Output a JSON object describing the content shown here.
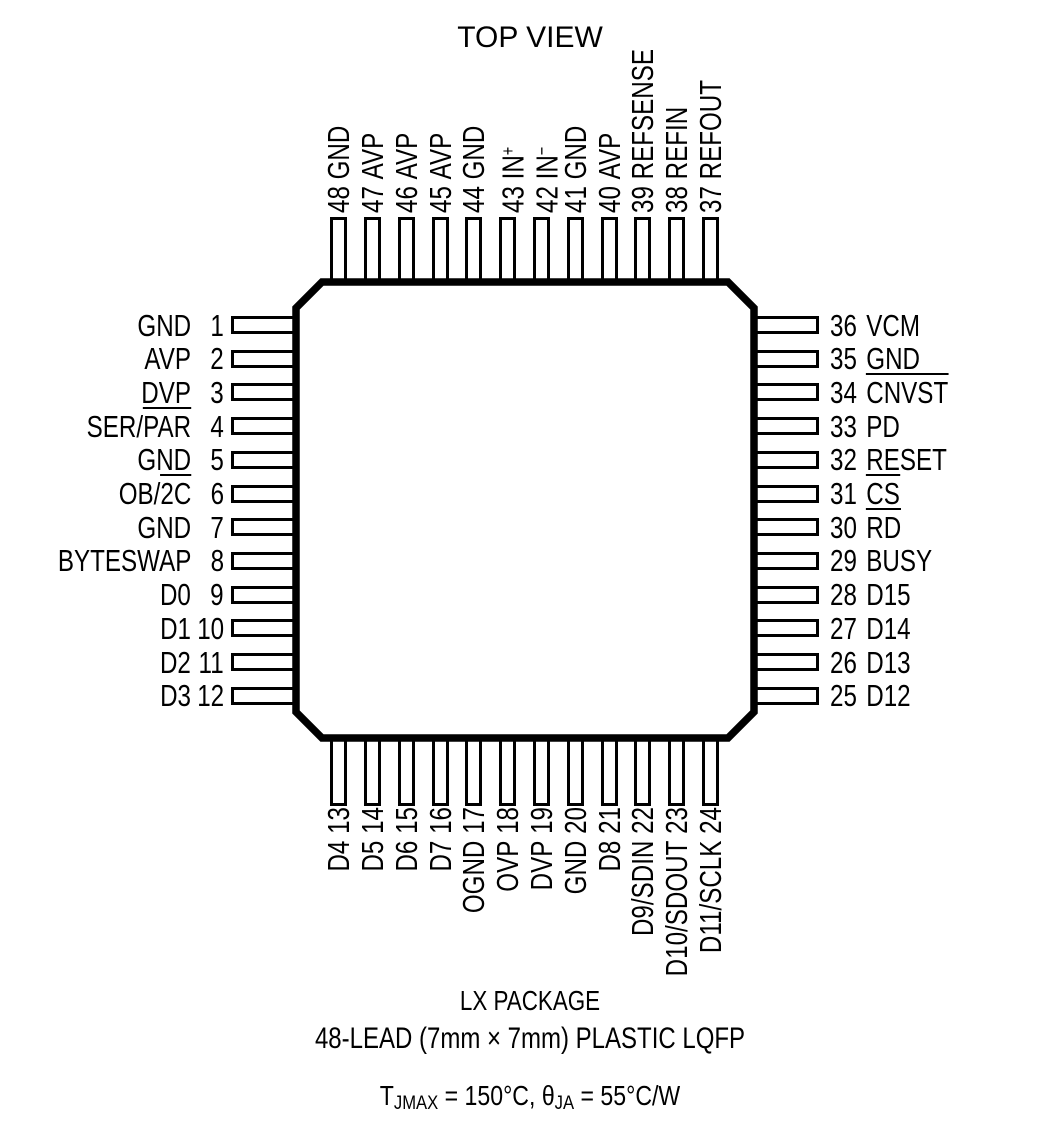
{
  "title": "TOP VIEW",
  "package": {
    "line1": "LX PACKAGE",
    "line2": "48-LEAD (7mm × 7mm) PLASTIC LQFP"
  },
  "thermal": {
    "t_prefix": "T",
    "t_sub": "JMAX",
    "mid": " = 150°C, θ",
    "ja_sub": "JA",
    "suffix": " = 55°C/W"
  },
  "colors": {
    "ink": "#000000",
    "background": "#ffffff"
  },
  "pins": {
    "top": [
      {
        "n": "48",
        "segs": [
          {
            "t": "GND"
          }
        ]
      },
      {
        "n": "47",
        "segs": [
          {
            "t": "AVP"
          }
        ]
      },
      {
        "n": "46",
        "segs": [
          {
            "t": "AVP"
          }
        ]
      },
      {
        "n": "45",
        "segs": [
          {
            "t": "AVP"
          }
        ]
      },
      {
        "n": "44",
        "segs": [
          {
            "t": "GND"
          }
        ]
      },
      {
        "n": "43",
        "segs": [
          {
            "t": "IN"
          },
          {
            "t": "+",
            "s": "sup"
          }
        ]
      },
      {
        "n": "42",
        "segs": [
          {
            "t": "IN"
          },
          {
            "t": "−",
            "s": "sup"
          }
        ]
      },
      {
        "n": "41",
        "segs": [
          {
            "t": "GND"
          }
        ]
      },
      {
        "n": "40",
        "segs": [
          {
            "t": "AVP"
          }
        ]
      },
      {
        "n": "39",
        "segs": [
          {
            "t": "REFSENSE"
          }
        ]
      },
      {
        "n": "38",
        "segs": [
          {
            "t": "REFIN"
          }
        ]
      },
      {
        "n": "37",
        "segs": [
          {
            "t": "REFOUT"
          }
        ]
      }
    ],
    "left": [
      {
        "n": "1",
        "segs": [
          {
            "t": "GND"
          }
        ]
      },
      {
        "n": "2",
        "segs": [
          {
            "t": "AVP"
          }
        ]
      },
      {
        "n": "3",
        "segs": [
          {
            "t": "DVP"
          }
        ]
      },
      {
        "n": "4",
        "segs": [
          {
            "t": "SER/"
          },
          {
            "t": "PAR",
            "s": "ov"
          }
        ]
      },
      {
        "n": "5",
        "segs": [
          {
            "t": "GND"
          }
        ]
      },
      {
        "n": "6",
        "segs": [
          {
            "t": "OB/"
          },
          {
            "t": "2C",
            "s": "ov"
          }
        ]
      },
      {
        "n": "7",
        "segs": [
          {
            "t": "GND"
          }
        ]
      },
      {
        "n": "8",
        "segs": [
          {
            "t": "BYTESWAP"
          }
        ]
      },
      {
        "n": "9",
        "segs": [
          {
            "t": "D0"
          }
        ]
      },
      {
        "n": "10",
        "segs": [
          {
            "t": "D1"
          }
        ]
      },
      {
        "n": "11",
        "segs": [
          {
            "t": "D2"
          }
        ]
      },
      {
        "n": "12",
        "segs": [
          {
            "t": "D3"
          }
        ]
      }
    ],
    "right": [
      {
        "n": "36",
        "segs": [
          {
            "t": "VCM"
          }
        ]
      },
      {
        "n": "35",
        "segs": [
          {
            "t": "GND"
          }
        ]
      },
      {
        "n": "34",
        "segs": [
          {
            "t": "CNVST",
            "s": "ov"
          }
        ]
      },
      {
        "n": "33",
        "segs": [
          {
            "t": "PD"
          }
        ]
      },
      {
        "n": "32",
        "segs": [
          {
            "t": "RESET"
          }
        ]
      },
      {
        "n": "31",
        "segs": [
          {
            "t": "CS",
            "s": "ov"
          }
        ]
      },
      {
        "n": "30",
        "segs": [
          {
            "t": "RD",
            "s": "ov"
          }
        ]
      },
      {
        "n": "29",
        "segs": [
          {
            "t": "BUSY"
          }
        ]
      },
      {
        "n": "28",
        "segs": [
          {
            "t": "D15"
          }
        ]
      },
      {
        "n": "27",
        "segs": [
          {
            "t": "D14"
          }
        ]
      },
      {
        "n": "26",
        "segs": [
          {
            "t": "D13"
          }
        ]
      },
      {
        "n": "25",
        "segs": [
          {
            "t": "D12"
          }
        ]
      }
    ],
    "bottom": [
      {
        "n": "13",
        "segs": [
          {
            "t": "D4"
          }
        ]
      },
      {
        "n": "14",
        "segs": [
          {
            "t": "D5"
          }
        ]
      },
      {
        "n": "15",
        "segs": [
          {
            "t": "D6"
          }
        ]
      },
      {
        "n": "16",
        "segs": [
          {
            "t": "D7"
          }
        ]
      },
      {
        "n": "17",
        "segs": [
          {
            "t": "OGND"
          }
        ]
      },
      {
        "n": "18",
        "segs": [
          {
            "t": "OVP"
          }
        ]
      },
      {
        "n": "19",
        "segs": [
          {
            "t": "DVP"
          }
        ]
      },
      {
        "n": "20",
        "segs": [
          {
            "t": "GND"
          }
        ]
      },
      {
        "n": "21",
        "segs": [
          {
            "t": "D8"
          }
        ]
      },
      {
        "n": "22",
        "segs": [
          {
            "t": "D9/SDIN"
          }
        ]
      },
      {
        "n": "23",
        "segs": [
          {
            "t": "D10/SDOUT"
          }
        ]
      },
      {
        "n": "24",
        "segs": [
          {
            "t": "D11/SCLK"
          }
        ]
      }
    ]
  }
}
